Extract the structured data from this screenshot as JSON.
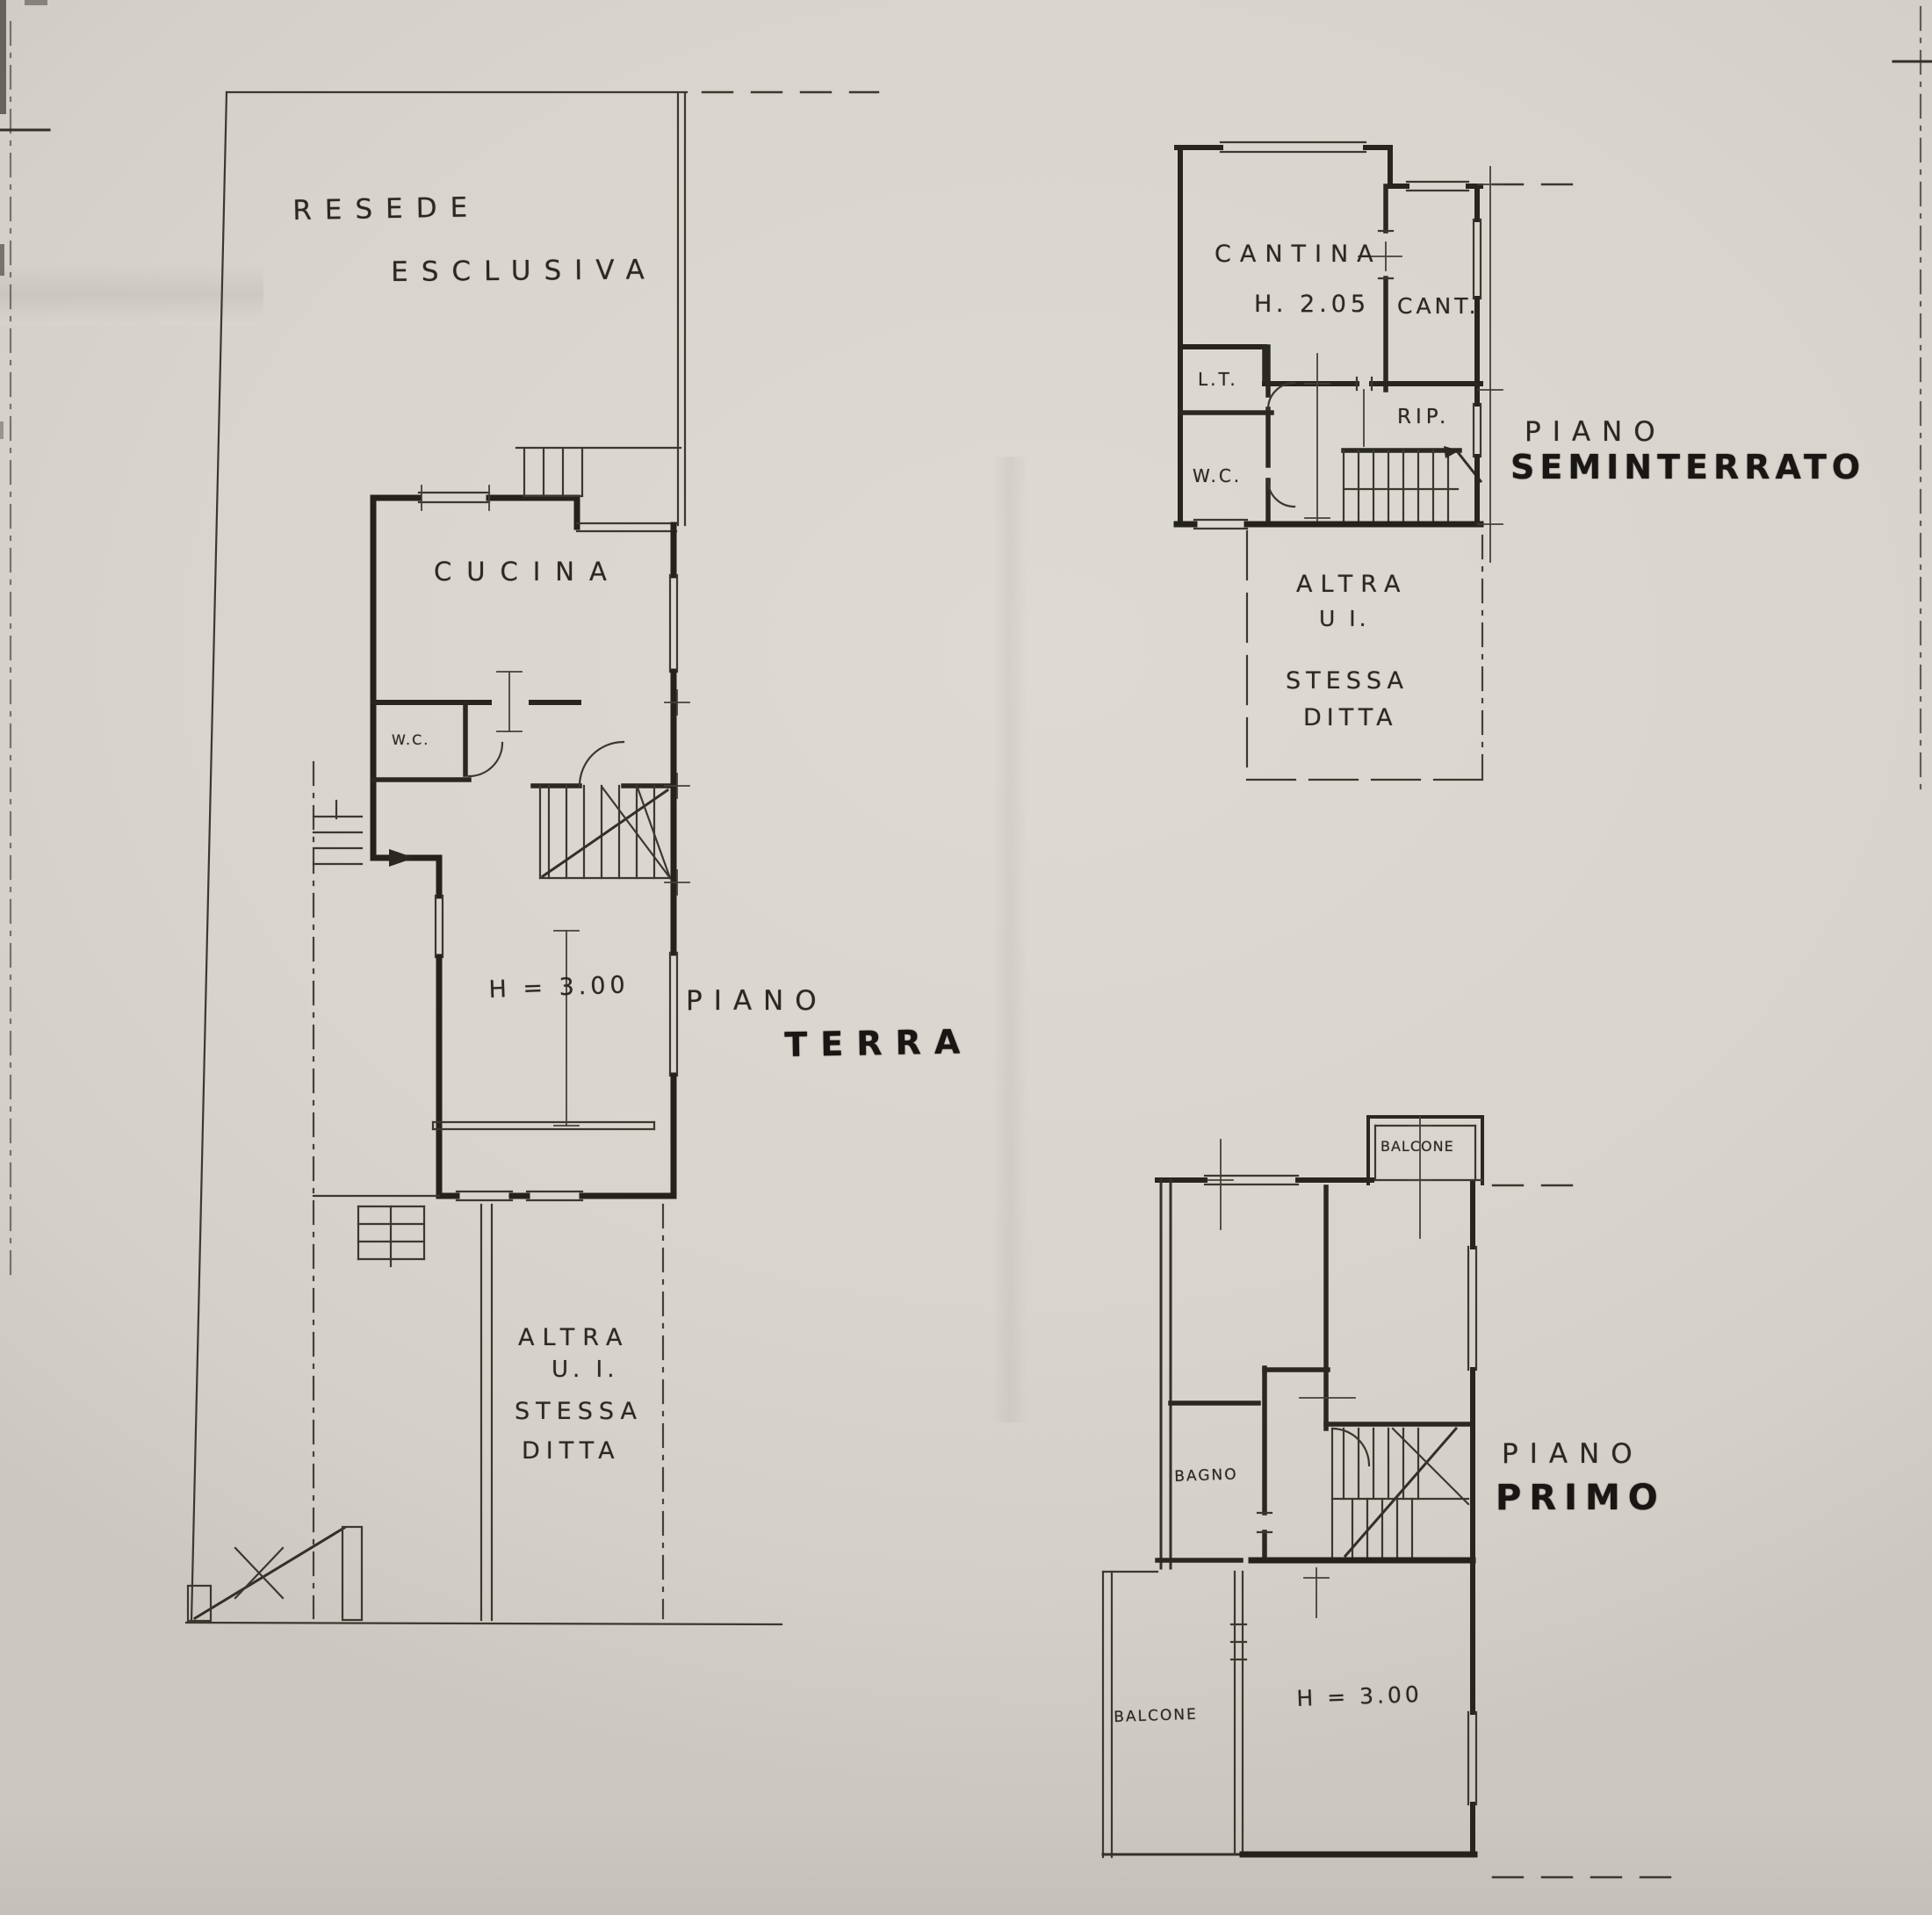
{
  "document": {
    "kind_label": "scanned cadastral floor plan drawing"
  },
  "colors": {
    "paper": "#d8d5ce",
    "ink_heavy": "#25221d",
    "ink_light": "#3c3830",
    "label_ink": "#2b2722"
  },
  "plans": {
    "terra": {
      "site": {
        "line1": "RESEDE",
        "line2": "ESCLUSIVA"
      },
      "rooms": {
        "cucina": "CUCINA",
        "wc": "W.C."
      },
      "height_note": "H = 3.00",
      "floor": {
        "line1": "PIANO",
        "line2": "TERRA"
      },
      "other_unit": {
        "line1": "ALTRA",
        "line2": "U. I.",
        "line3": "STESSA",
        "line4": "DITTA"
      }
    },
    "seminterrato": {
      "rooms": {
        "cantina": "CANTINA",
        "cantina_height": "H. 2.05",
        "cant": "CANT.",
        "lt": "L.T.",
        "wc": "W.C.",
        "rip": "RIP."
      },
      "floor": {
        "line1": "PIANO",
        "line2": "SEMINTERRATO"
      },
      "other_unit": {
        "line1": "ALTRA",
        "line2": "U I.",
        "line3": "STESSA",
        "line4": "DITTA"
      }
    },
    "primo": {
      "rooms": {
        "balcone_top": "BALCONE",
        "bagno": "BAGNO",
        "balcone_bottom": "BALCONE"
      },
      "height_note": "H = 3.00",
      "floor": {
        "line1": "PIANO",
        "line2": "PRIMO"
      }
    }
  }
}
